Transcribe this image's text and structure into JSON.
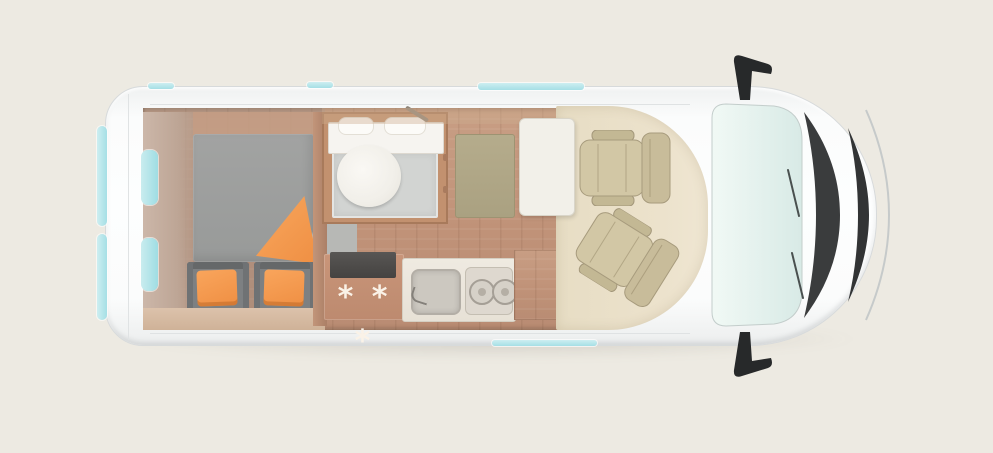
{
  "scene": {
    "background_color": "#edeae2",
    "subject": "campervan-floorplan-top-view"
  },
  "palette": {
    "van_body_white": "#fbfcfc",
    "accent_window_blue": "#aee3e8",
    "wood_floor": "#c09278",
    "cab_floor_beige": "#e9dfc6",
    "cab_seat_beige": "#d1c6a4",
    "mattress_gray": "#9d9e9d",
    "bench_gray": "#7d8082",
    "textile_orange": "#f49950",
    "bathroom_floor_gray": "#d2d4d2",
    "toilet_white": "#f5f3ef",
    "table_white": "#f2f0e9",
    "mat_olive": "#b0a786",
    "front_trim_dark": "#3a3c3d",
    "fridge_top_dark": "#4d4b49"
  },
  "fridge": {
    "symbols": "* * *"
  }
}
